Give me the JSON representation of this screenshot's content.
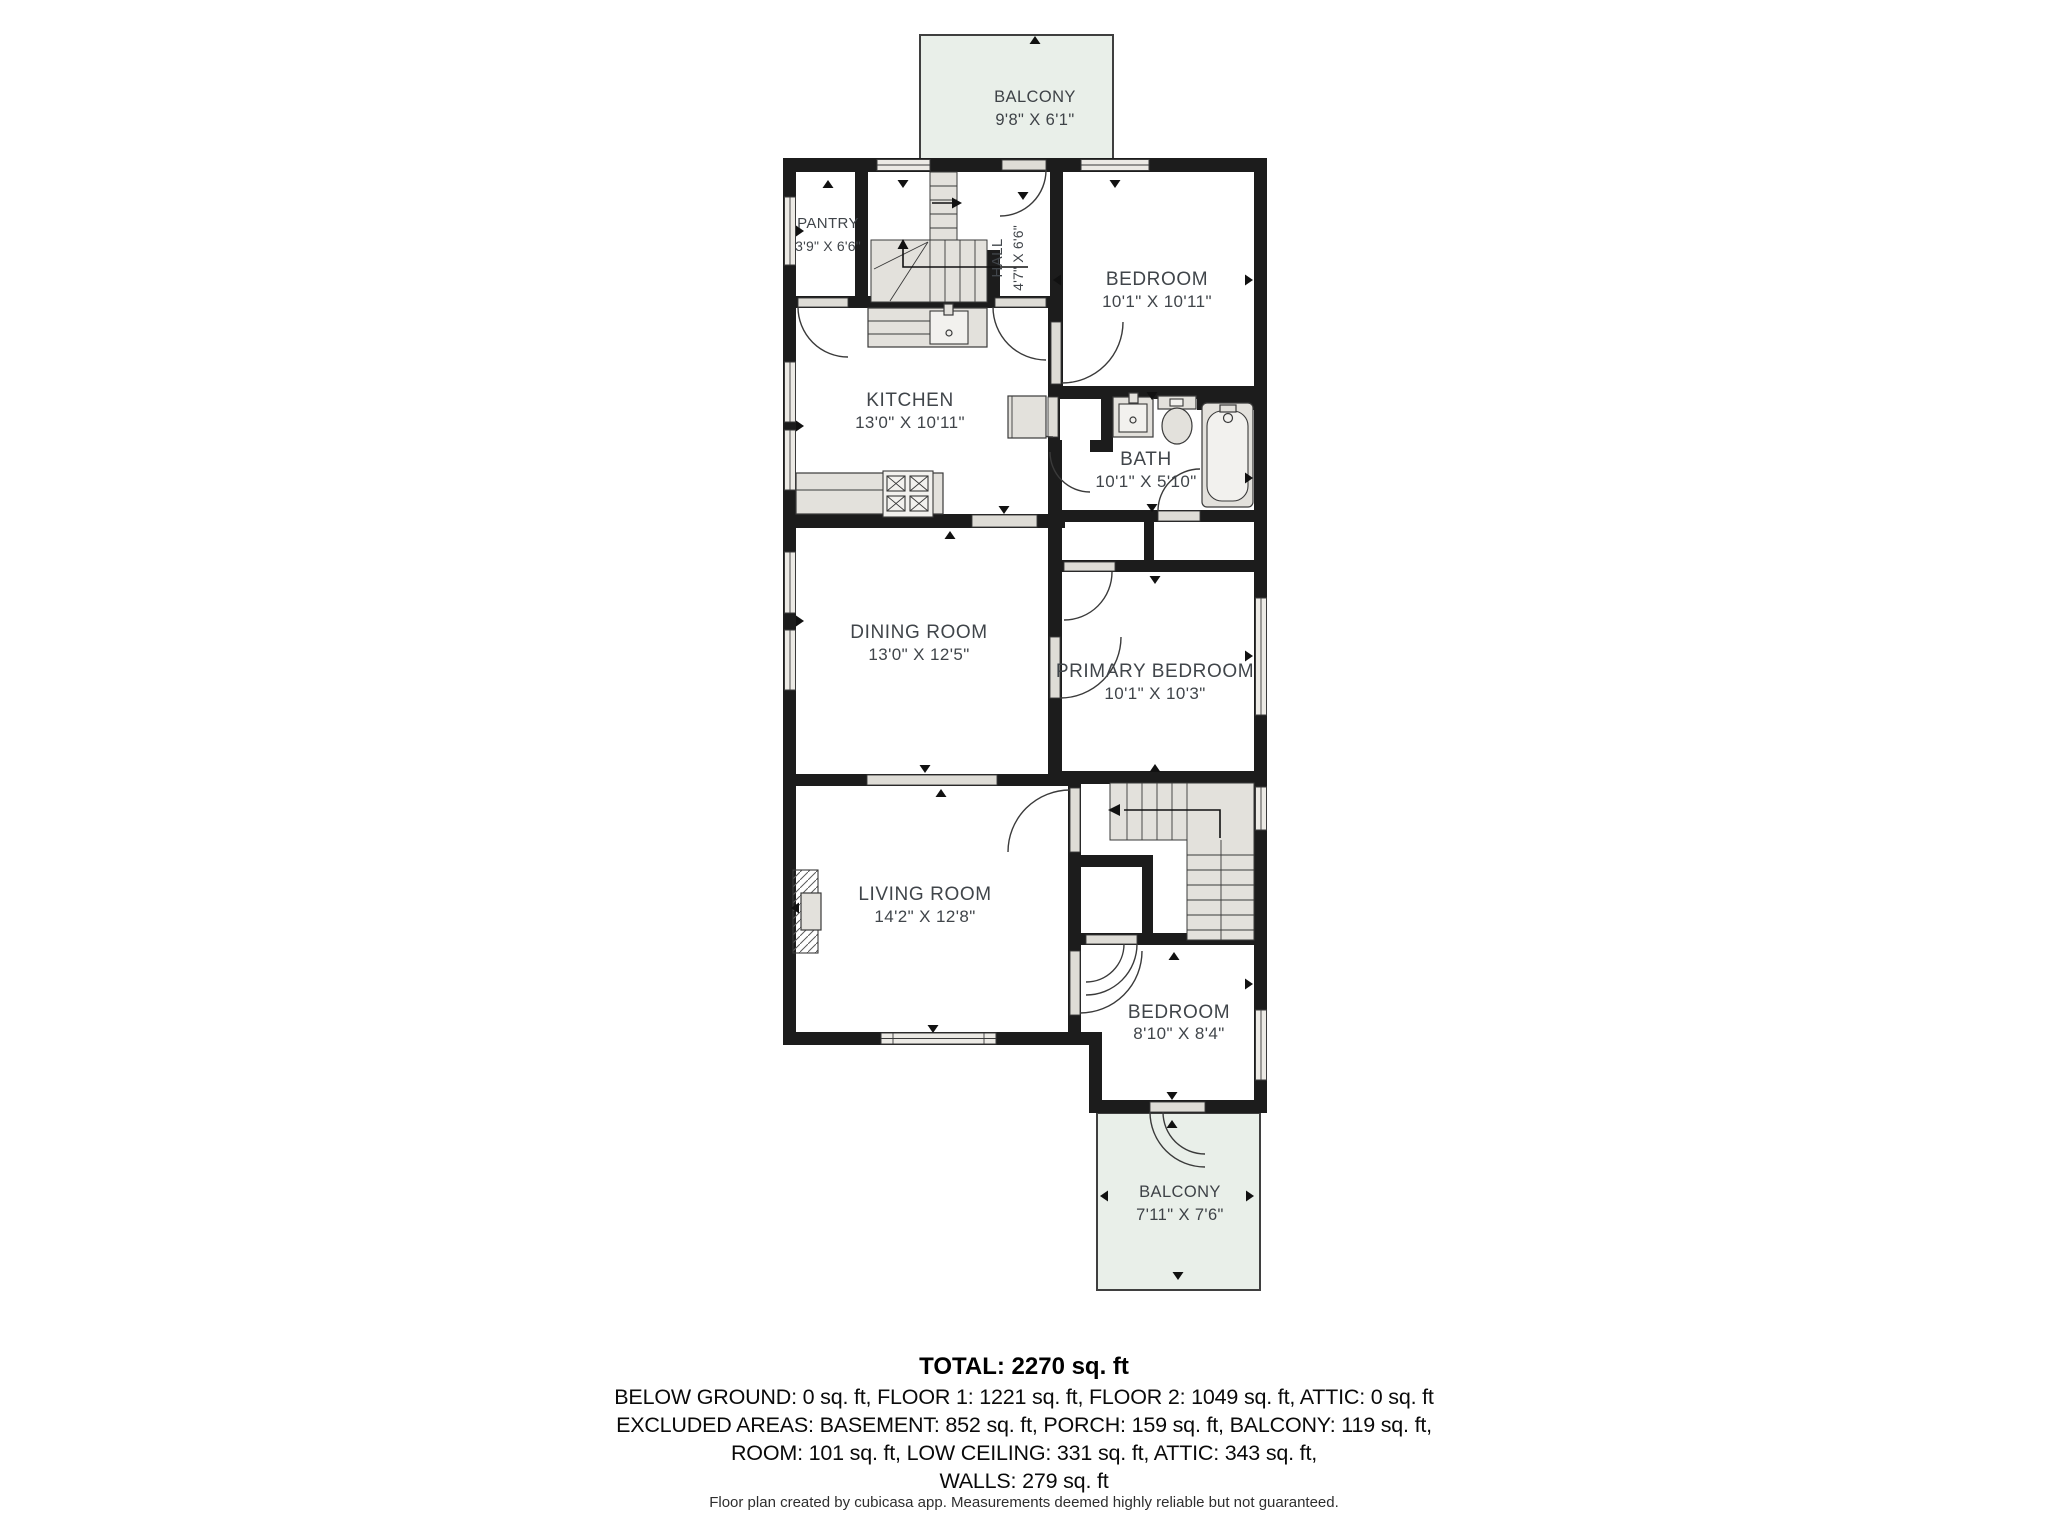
{
  "plan": {
    "balcony_top": {
      "name": "BALCONY",
      "dims": "9'8\" X 6'1\""
    },
    "pantry": {
      "name": "PANTRY",
      "dims": "3'9\" X 6'6\""
    },
    "hall": {
      "name": "HALL",
      "dims": "4'7\" X 6'6\""
    },
    "bedroom_top": {
      "name": "BEDROOM",
      "dims": "10'1\" X 10'11\""
    },
    "kitchen": {
      "name": "KITCHEN",
      "dims": "13'0\" X 10'11\""
    },
    "bath": {
      "name": "BATH",
      "dims": "10'1\" X 5'10\""
    },
    "dining_room": {
      "name": "DINING ROOM",
      "dims": "13'0\" X 12'5\""
    },
    "primary_bedroom": {
      "name": "PRIMARY BEDROOM",
      "dims": "10'1\" X 10'3\""
    },
    "living_room": {
      "name": "LIVING ROOM",
      "dims": "14'2\" X 12'8\""
    },
    "bedroom_bottom": {
      "name": "BEDROOM",
      "dims": "8'10\" X 8'4\""
    },
    "balcony_bottom": {
      "name": "BALCONY",
      "dims": "7'11\" X 7'6\""
    }
  },
  "summary": {
    "total": "TOTAL: 2270 sq. ft",
    "floors": "BELOW GROUND: 0 sq. ft, FLOOR 1: 1221 sq. ft, FLOOR 2: 1049 sq. ft, ATTIC: 0 sq. ft",
    "excluded_1": "EXCLUDED AREAS: BASEMENT: 852 sq. ft, PORCH: 159 sq. ft, BALCONY: 119 sq. ft,",
    "excluded_2": "ROOM: 101 sq. ft, LOW CEILING: 331 sq. ft, ATTIC: 343 sq. ft,",
    "walls": "WALLS: 279 sq. ft"
  },
  "footer": "Floor plan created by cubicasa app. Measurements deemed highly reliable but not guaranteed.",
  "colors": {
    "wall": "#1c1c1c",
    "balcony_fill": "#e9efe9",
    "fixture_fill": "#e3e1dc",
    "door_fill": "#dedcd6",
    "window_fill": "#eceae5",
    "label_text": "#40454a"
  }
}
